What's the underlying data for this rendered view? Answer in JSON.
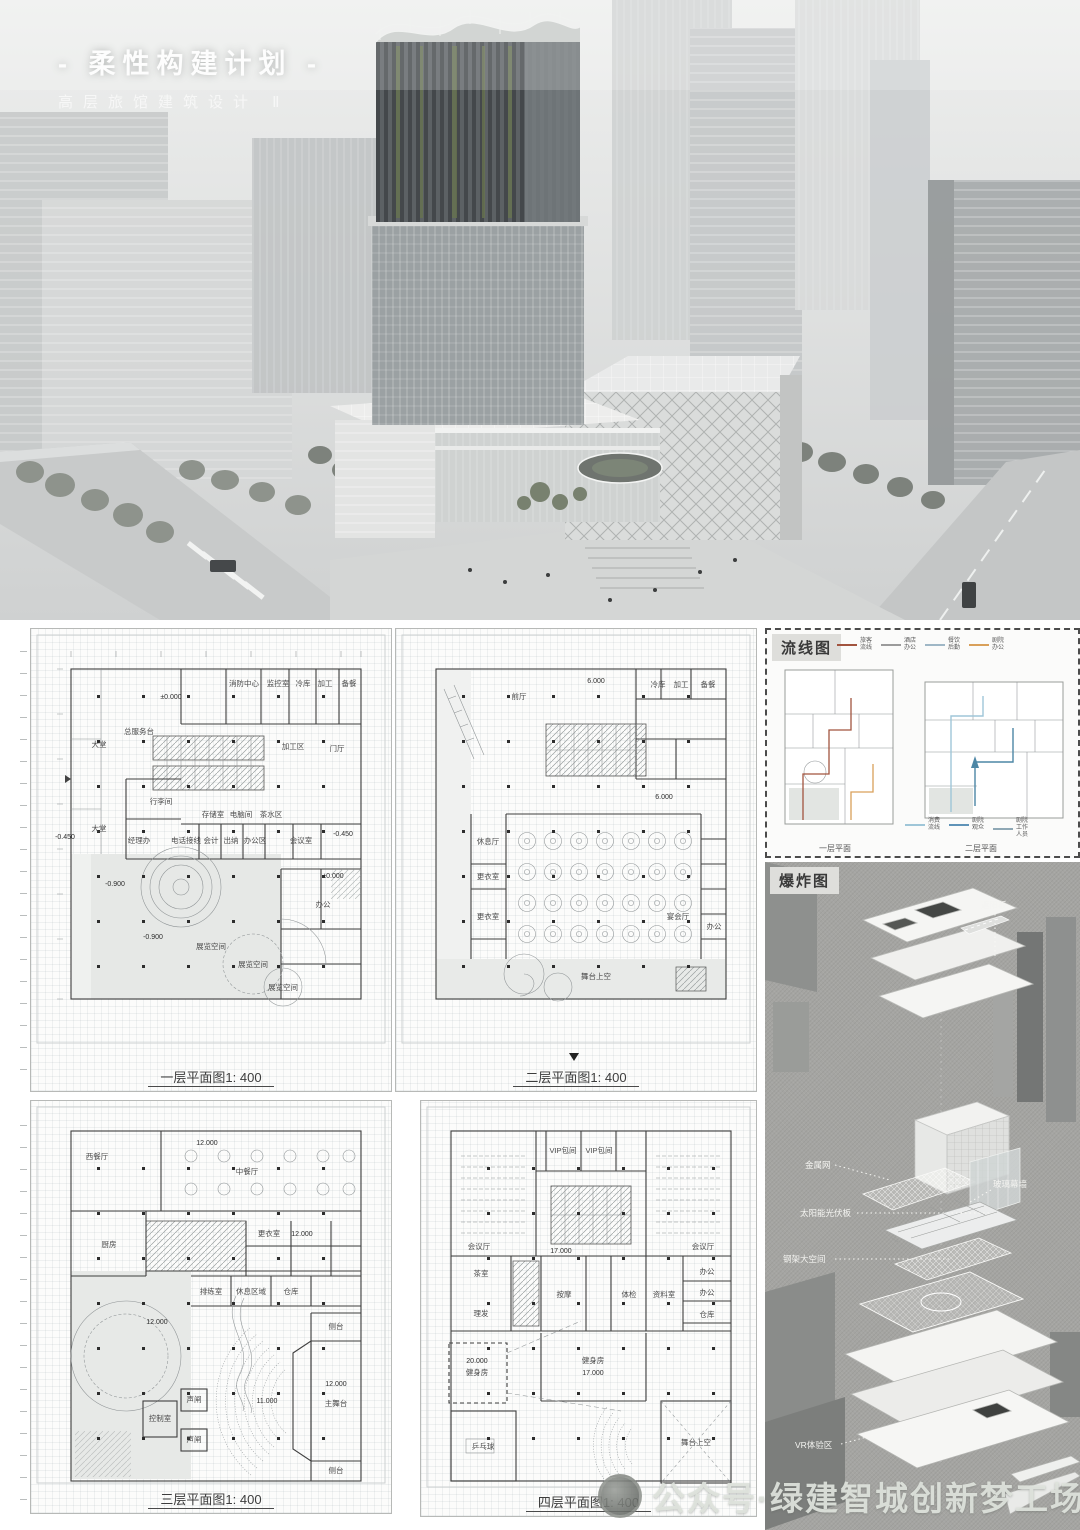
{
  "board": {
    "title": "- 柔性构建计划 -",
    "subtitle": "高层旅馆建筑设计 Ⅱ"
  },
  "plans": {
    "p1": {
      "title": "一层平面图1: 400",
      "labels": [
        "消防中心",
        "监控室",
        "冷库",
        "加工",
        "备餐",
        "±0.000",
        "大堂",
        "总服务台",
        "行李间",
        "存储室",
        "电脑间",
        "茶水区",
        "加工区",
        "门厅",
        "经理办",
        "电话接线",
        "会计",
        "出纳",
        "办公区",
        "会议室",
        "大堂",
        "-0.450",
        "-0.450",
        "-0.900",
        "±0.000",
        "-0.900",
        "展览空间",
        "展览空间",
        "展览空间",
        "办公"
      ]
    },
    "p2": {
      "title": "二层平面图1: 400",
      "labels": [
        "6.000",
        "冷库",
        "加工",
        "备餐",
        "前厅",
        "休息厅",
        "更衣室",
        "宴会厅",
        "更衣室",
        "6.000",
        "舞台上空",
        "办公"
      ]
    },
    "p3": {
      "title": "三层平面图1: 400",
      "labels": [
        "西餐厅",
        "12.000",
        "中餐厅",
        "12.000",
        "厨房",
        "更衣室",
        "排练室",
        "休息区域",
        "仓库",
        "12.000",
        "侧台",
        "12.000",
        "主舞台",
        "11.000",
        "侧台",
        "声闸",
        "控制室",
        "声闸"
      ]
    },
    "p4": {
      "title": "四层平面图1: 400",
      "labels": [
        "VIP包间",
        "VIP包间",
        "会议厅",
        "17.000",
        "会议厅",
        "茶室",
        "按摩",
        "体检",
        "资料室",
        "理发",
        "健身房",
        "17.000",
        "办公",
        "办公",
        "仓库",
        "20.000",
        "健身房",
        "乒乓球",
        "舞台上空"
      ]
    }
  },
  "circulation": {
    "title": "流线图",
    "legend_top": [
      {
        "l1": "旅客",
        "l2": "流线",
        "color": "#a2543f"
      },
      {
        "l1": "酒店",
        "l2": "办公",
        "color": "#9b9b9b"
      },
      {
        "l1": "餐饮",
        "l2": "后勤",
        "color": "#9fb7c6"
      },
      {
        "l1": "剧院",
        "l2": "办公",
        "color": "#d9a05a"
      }
    ],
    "legend_bottom": [
      {
        "l1": "消费",
        "l2": "流线",
        "color": "#9fc6d8"
      },
      {
        "l1": "剧院",
        "l2": "观众",
        "color": "#5f93b8"
      },
      {
        "l1": "剧院",
        "l2": "工作",
        "l3": "人员",
        "color": "#8fa8b5"
      }
    ],
    "captions": [
      "一层平面",
      "二层平面"
    ]
  },
  "exploded": {
    "title": "爆炸图",
    "annotations": [
      "遮阳板",
      "金属网",
      "玻璃幕墙",
      "太阳能光伏板",
      "钢架大空间",
      "VR体验区"
    ]
  },
  "watermark": {
    "text": "公众号·绿建智城创新梦工场"
  }
}
